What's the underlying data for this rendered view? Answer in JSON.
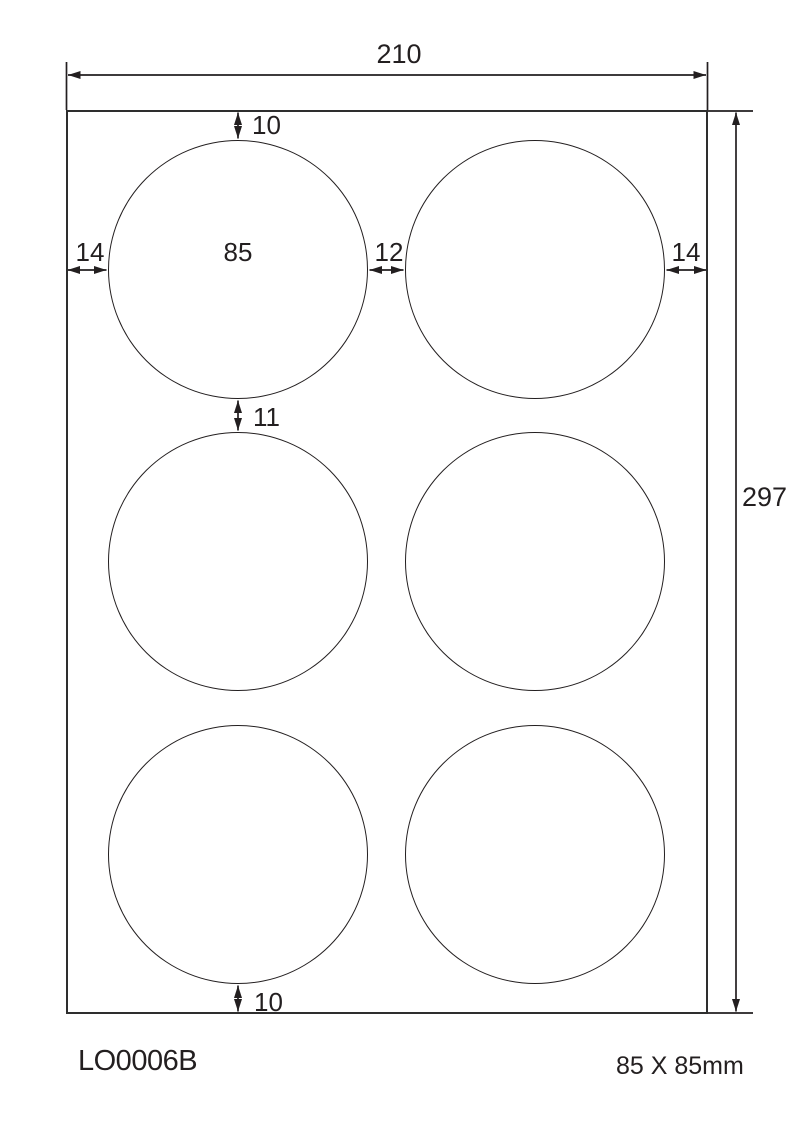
{
  "diagram": {
    "product_code": "LO0006B",
    "label_size_text": "85 X 85mm",
    "unit": "mm",
    "sheet": {
      "width_mm": 210,
      "height_mm": 297
    },
    "labels": {
      "shape": "circle",
      "diameter_mm": 85,
      "columns": 2,
      "rows": 3,
      "count": 6
    },
    "dimensions": {
      "sheet_width": "210",
      "sheet_height": "297",
      "margin_top": "10",
      "margin_bottom": "10",
      "margin_left": "14",
      "margin_right": "14",
      "label_diameter": "85",
      "gap_horizontal": "12",
      "gap_vertical": "11"
    },
    "colors": {
      "line": "#231f20",
      "sheet_outline": "#2e2e2e",
      "background": "#ffffff"
    }
  }
}
